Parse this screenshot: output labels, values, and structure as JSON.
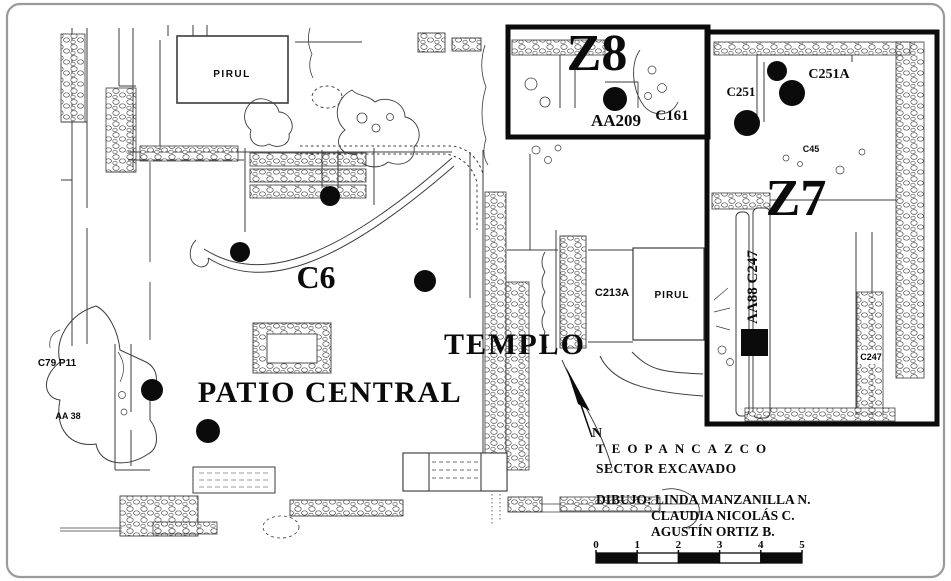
{
  "canvas": {
    "background": "#ffffff",
    "frame_border": "#9a9a9a",
    "ink": "#0b0b0b",
    "linework": "#3c3c3c"
  },
  "map": {
    "labels": [
      {
        "id": "pirul-north",
        "text": "PIRUL",
        "x": 232,
        "y": 77,
        "size": 10,
        "font": "sans",
        "spacing": 1.5
      },
      {
        "id": "zone-z8",
        "text": "Z8",
        "x": 597,
        "y": 70,
        "size": 52,
        "font": "serif"
      },
      {
        "id": "aa209",
        "text": "AA209",
        "x": 616,
        "y": 126,
        "size": 17,
        "font": "serif"
      },
      {
        "id": "c161",
        "text": "C161",
        "x": 672,
        "y": 120,
        "size": 15,
        "font": "serif"
      },
      {
        "id": "c251",
        "text": "C251",
        "x": 741,
        "y": 96,
        "size": 13,
        "font": "serif"
      },
      {
        "id": "c251a",
        "text": "C251A",
        "x": 829,
        "y": 78,
        "size": 14,
        "font": "serif"
      },
      {
        "id": "c45",
        "text": "C45",
        "x": 811,
        "y": 152,
        "size": 9,
        "font": "sans"
      },
      {
        "id": "zone-z7",
        "text": "Z7",
        "x": 796,
        "y": 215,
        "size": 52,
        "font": "serif"
      },
      {
        "id": "aa88-c247",
        "text": "AA88 C247",
        "x": 757,
        "y": 287,
        "size": 15,
        "font": "serif",
        "rotate": -90
      },
      {
        "id": "c247",
        "text": "C247",
        "x": 871,
        "y": 360,
        "size": 9,
        "font": "sans"
      },
      {
        "id": "c213a",
        "text": "C213A",
        "x": 612,
        "y": 296,
        "size": 11,
        "font": "sans"
      },
      {
        "id": "pirul-east",
        "text": "PIRUL",
        "x": 672,
        "y": 298,
        "size": 10,
        "font": "sans",
        "spacing": 1
      },
      {
        "id": "c6",
        "text": "C6",
        "x": 316,
        "y": 288,
        "size": 32,
        "font": "serif"
      },
      {
        "id": "templo",
        "text": "TEMPLO",
        "x": 515,
        "y": 354,
        "size": 30,
        "font": "serif",
        "spacing": 2
      },
      {
        "id": "patio-central",
        "text": "PATIO CENTRAL",
        "x": 330,
        "y": 402,
        "size": 30,
        "font": "serif",
        "spacing": 1.5
      },
      {
        "id": "c79-p11",
        "text": "C79 P11",
        "x": 57,
        "y": 366,
        "size": 10,
        "font": "sans"
      },
      {
        "id": "aa-38",
        "text": "AA 38",
        "x": 68,
        "y": 419,
        "size": 9,
        "font": "sans"
      },
      {
        "id": "north-n",
        "text": "N",
        "x": 597,
        "y": 437,
        "size": 14,
        "font": "serif"
      }
    ],
    "dots": [
      {
        "x": 330,
        "y": 196,
        "r": 10
      },
      {
        "x": 240,
        "y": 252,
        "r": 10
      },
      {
        "x": 425,
        "y": 281,
        "r": 11
      },
      {
        "x": 152,
        "y": 390,
        "r": 11
      },
      {
        "x": 208,
        "y": 431,
        "r": 12
      },
      {
        "x": 615,
        "y": 99,
        "r": 12
      },
      {
        "x": 777,
        "y": 71,
        "r": 10
      },
      {
        "x": 792,
        "y": 93,
        "r": 13
      },
      {
        "x": 747,
        "y": 123,
        "r": 13
      }
    ],
    "square_marker": {
      "x": 741,
      "y": 329,
      "size": 27
    },
    "scalebar": {
      "x": 596,
      "y": 553,
      "width": 206,
      "height": 10,
      "ticks": [
        "0",
        "1",
        "2",
        "3",
        "4",
        "5"
      ],
      "segments": [
        "black",
        "white",
        "black",
        "white",
        "black"
      ]
    }
  },
  "caption": {
    "site": "TEOPANCAZCO",
    "sector": "SECTOR EXCAVADO",
    "credit1": "DIBUJO: LINDA MANZANILLA N.",
    "credit2": "CLAUDIA NICOLÁS C.",
    "credit3": "AGUSTÍN ORTIZ B."
  }
}
